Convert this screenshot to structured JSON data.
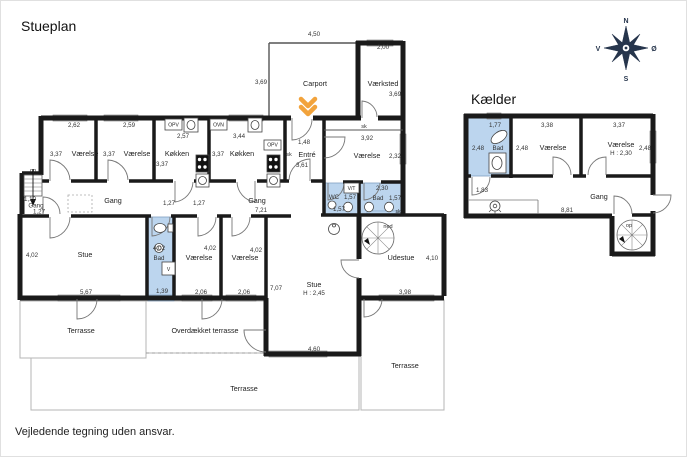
{
  "page": {
    "title": "Stueplan",
    "basement_title": "Kælder",
    "disclaimer": "Vejledende tegning uden ansvar."
  },
  "compass": {
    "north": "N",
    "east": "Ø",
    "south": "S",
    "west": "V"
  },
  "ground_floor": {
    "bedroom_nw1": {
      "label": "Værelse",
      "width": "2,62",
      "depth": "3,37"
    },
    "bedroom_nw2": {
      "label": "Værelse",
      "width": "2,59",
      "depth": "3,37"
    },
    "kitchen1": {
      "label": "Køkken",
      "width": "2,57",
      "depth": "3,37",
      "dishwasher": "OPV"
    },
    "kitchen2": {
      "label": "Køkken",
      "width": "3,44",
      "depth": "3,37",
      "oven": "OVN",
      "dishwasher": "OPV",
      "closet": "sk"
    },
    "entre": {
      "label": "Entré",
      "width": "1,48",
      "depth": "3,61"
    },
    "carport": {
      "label": "Carport",
      "width": "4,50",
      "depth": "3,69"
    },
    "workshop": {
      "label": "Værksted",
      "width": "2,00",
      "depth": "3,69"
    },
    "bedroom_e": {
      "label": "Værelse",
      "width": "3,92",
      "depth": "2,32",
      "closet": "sk"
    },
    "hall_w": {
      "label": "Gang",
      "dim1": "1,10",
      "dim2": "1,27",
      "stairs_label": "op"
    },
    "hall_c": {
      "label": "Gang",
      "door1": "1,27",
      "door2": "1,27"
    },
    "hall_e": {
      "label": "Gang",
      "width": "7,21",
      "depth": "7,07"
    },
    "wc": {
      "label": "WC",
      "width": "1,57",
      "depth": "1,57",
      "washer_dryer": "V/T"
    },
    "bath_e": {
      "label": "Bad",
      "width": "2,30",
      "depth": "1,57",
      "closet": "sk"
    },
    "living_w": {
      "label": "Stue",
      "width": "5,67",
      "depth": "4,02"
    },
    "bath_c": {
      "label": "Bad",
      "width": "1,39",
      "depth": "4,02",
      "washer": "V"
    },
    "bedroom_s1": {
      "label": "Værelse",
      "width": "2,06",
      "depth": "4,02"
    },
    "bedroom_s2": {
      "label": "Værelse",
      "width": "2,06",
      "depth": "4,02"
    },
    "living_main": {
      "label": "Stue",
      "ceiling_height": "H : 2,45",
      "width": "4,60"
    },
    "conservatory": {
      "label": "Udestue",
      "width": "3,98",
      "depth": "4,10"
    },
    "stairs_down_label": "ned",
    "terrace_w": "Terrasse",
    "terrace_covered": "Overdækket terrasse",
    "terrace_s": "Terrasse",
    "terrace_e": "Terrasse"
  },
  "basement": {
    "bath": {
      "label": "Bad",
      "width": "1,77",
      "depth": "2,48"
    },
    "bedroom1": {
      "label": "Værelse",
      "width": "3,38",
      "depth": "2,48"
    },
    "bedroom2": {
      "label": "Værelse",
      "width": "3,37",
      "depth": "2,48",
      "ceiling_height": "H : 2,30"
    },
    "hall": {
      "label": "Gang",
      "width": "8,81",
      "depth": "1,83"
    },
    "stairs_up_label": "op"
  }
}
